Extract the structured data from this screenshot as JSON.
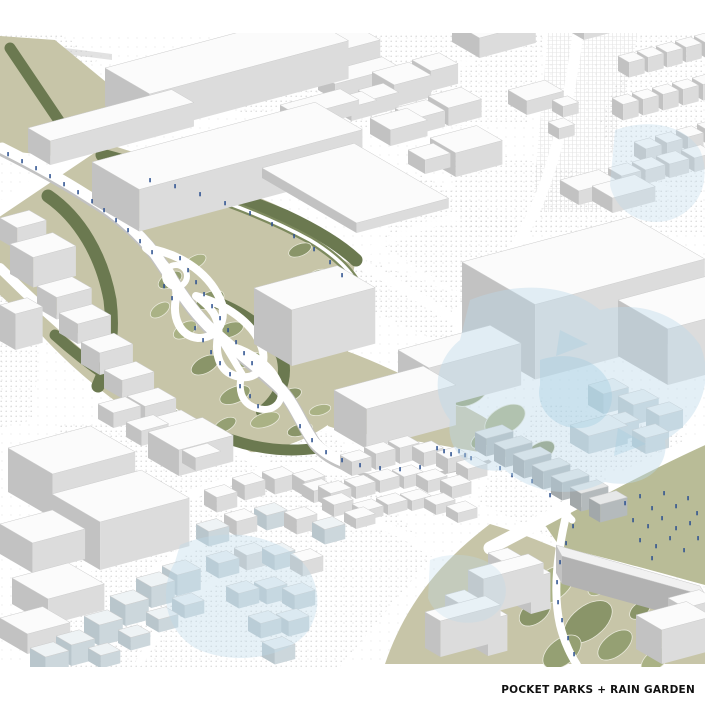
{
  "caption": "POCKET PARKS + RAIN GARDEN",
  "palette": {
    "background": "#ffffff",
    "park_green": "#c7c5a8",
    "park_green_dark": "#6b7950",
    "foliage_mid": "#95a073",
    "foliage_light": "#aab285",
    "lawn_green": "#b9bc97",
    "water_blue": "#bcdaea",
    "water_blue_deep": "#9fcbdf",
    "figure_blue": "#2f5390",
    "building_top": "#fbfbfb",
    "building_front": "#dcdcdc",
    "building_side": "#c2c2c2",
    "building_gray_top": "#e6e8e8",
    "building_gray_front": "#b4babc",
    "building_gray_side": "#a2a8aa",
    "building_blue_top": "#eef3f5",
    "building_blue_front": "#ccd7dc",
    "building_blue_side": "#b9c6cc",
    "halftone_dot": "#cfcfcf",
    "road_white": "#ffffff",
    "path_shadow": "#c2c2c2",
    "caption_color": "#111111"
  }
}
